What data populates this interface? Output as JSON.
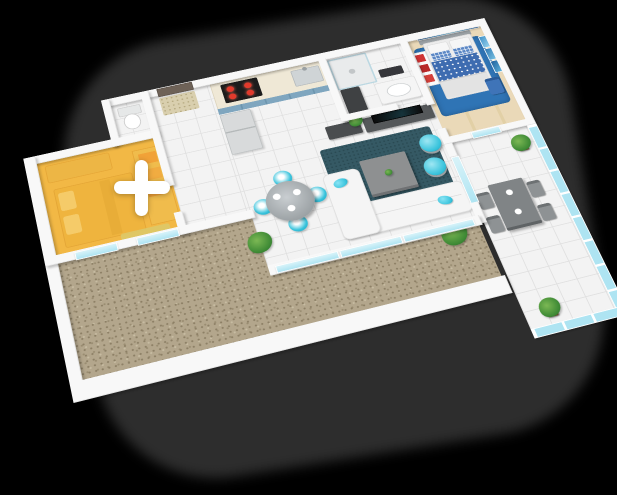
{
  "scene": {
    "description": "3D isometric apartment floor plan render with one bedroom highlighted for selection",
    "background": "#000000",
    "shadow": "#2d2d2d"
  },
  "overlay": {
    "plus_symbol": "+",
    "plus": "#ffffff"
  },
  "palette": {
    "highlight": "#f2b845",
    "highlight_deep": "#dd9c2e",
    "teal": "#38c3dc",
    "blue": "#2f74b5",
    "wall": "#f8f8f8",
    "tile": "#f3f3f3",
    "tile_line": "#e0e0e0",
    "wood": "#ead9b8",
    "gravel": "#b3a68c",
    "rug_dark": "#355964",
    "glass": "#aee4f2",
    "plant": "#3e8a35",
    "burner": "#e23a2c",
    "terrace_gray": "#808486"
  },
  "rooms": [
    {
      "name": "bedroom-highlighted",
      "selected": true
    },
    {
      "name": "wc",
      "selected": false
    },
    {
      "name": "hallway",
      "selected": false
    },
    {
      "name": "kitchen",
      "selected": false
    },
    {
      "name": "bathroom",
      "selected": false
    },
    {
      "name": "bedroom-master",
      "selected": false
    },
    {
      "name": "living-room",
      "selected": false
    },
    {
      "name": "dining-area",
      "selected": false
    },
    {
      "name": "terrace",
      "selected": false
    },
    {
      "name": "gravel-balcony",
      "selected": false
    }
  ]
}
